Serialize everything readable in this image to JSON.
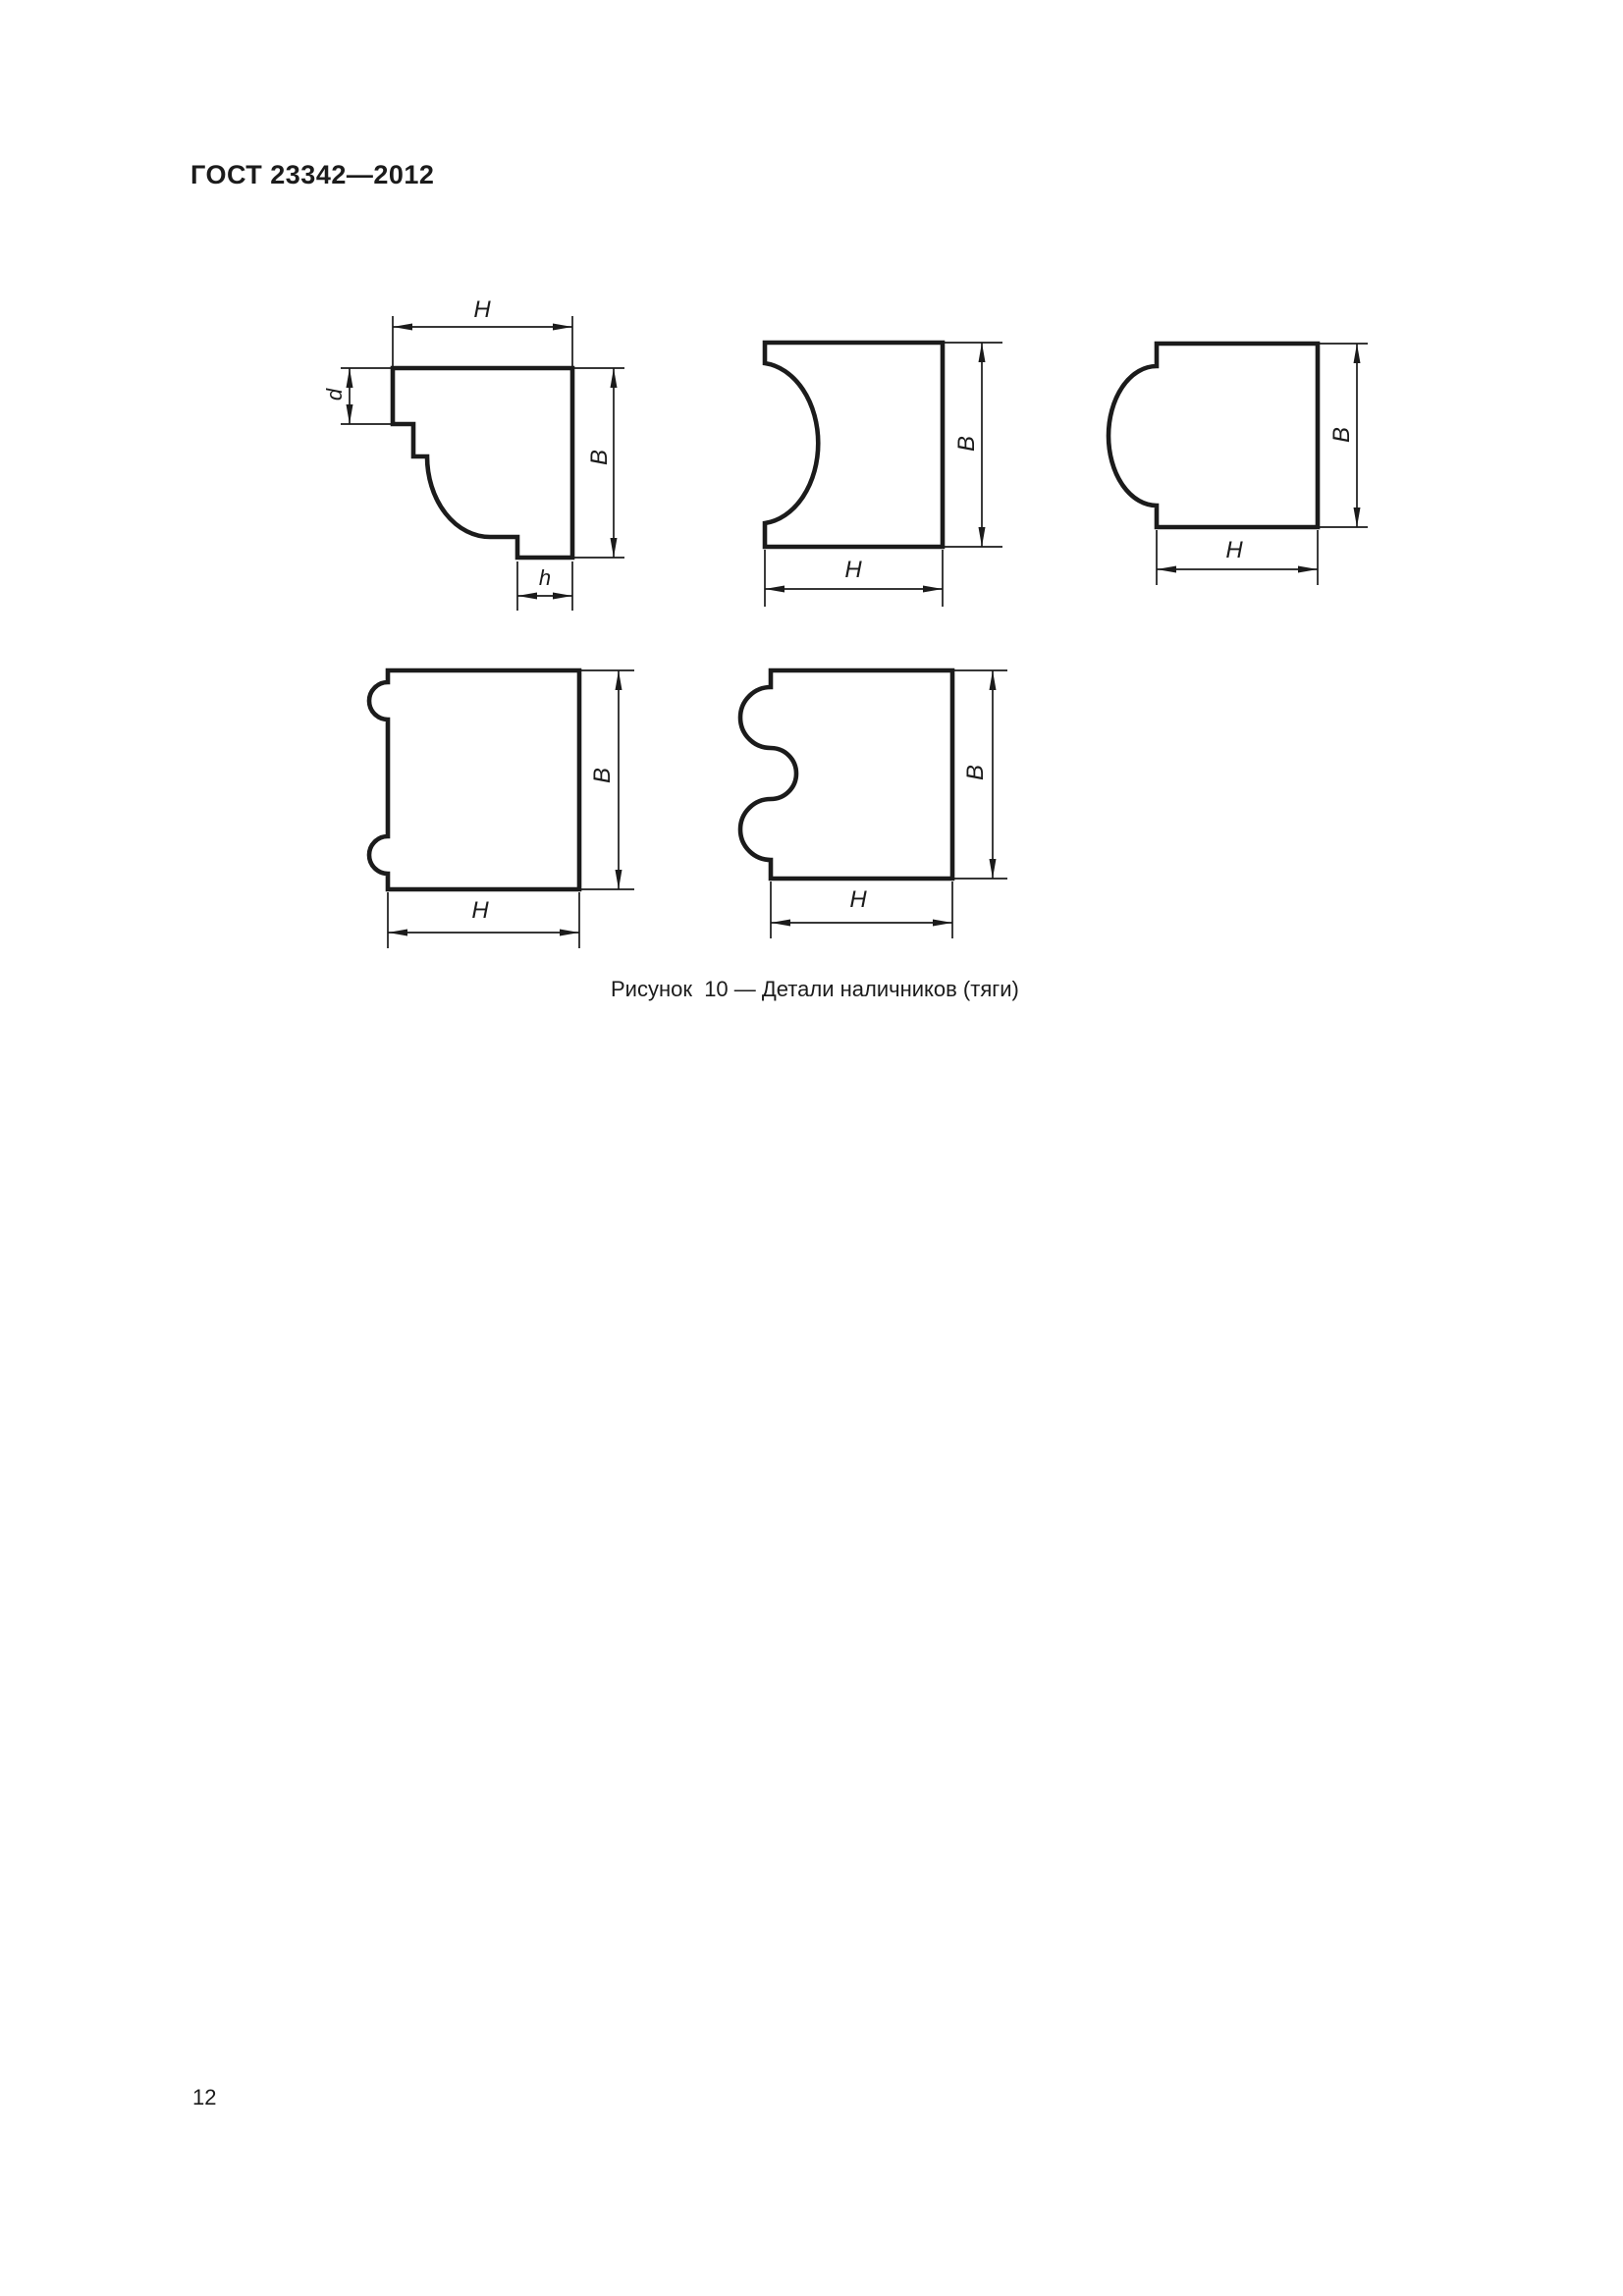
{
  "page": {
    "header": "ГОСТ 23342—2012",
    "number": "12"
  },
  "figure": {
    "caption": "Рисунок  10 — Детали наличников (тяги)"
  },
  "dims": {
    "H": "H",
    "B": "B",
    "d": "d",
    "h": "h"
  },
  "colors": {
    "ink": "#1b1b1b",
    "paper": "#ffffff"
  }
}
